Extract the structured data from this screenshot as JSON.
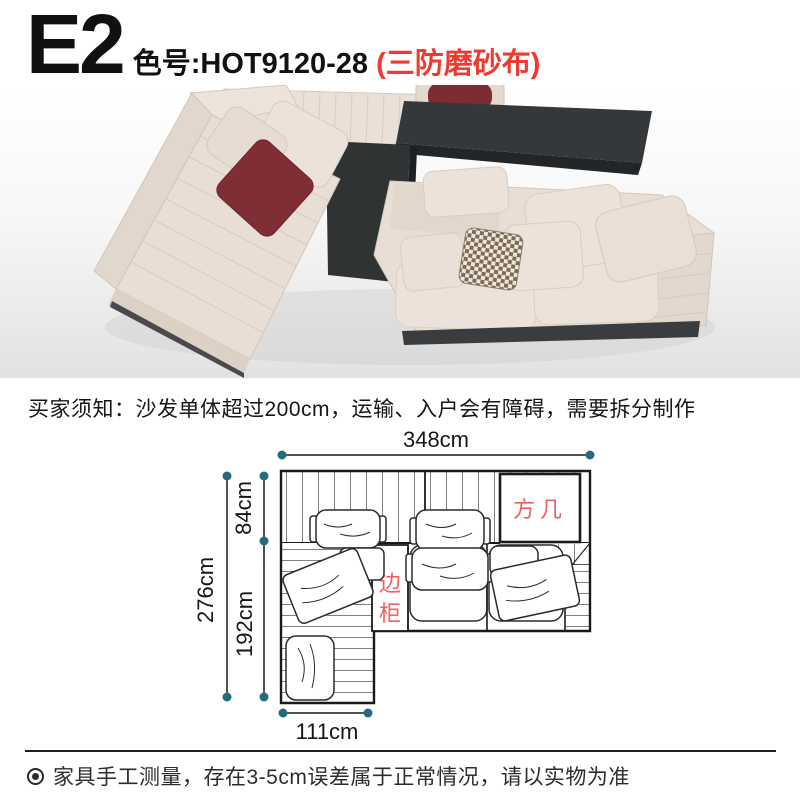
{
  "header": {
    "variant_code": "E2",
    "color_code_label": "色号:HOT9120-28",
    "fabric_badge": "(三防磨砂布)",
    "badge_color": "#ee3a2f"
  },
  "notice": {
    "buyer_note": "买家须知：沙发单体超过200cm，运输、入户会有障碍，需要拆分制作"
  },
  "diagram": {
    "total_width": "348cm",
    "total_depth": "276cm",
    "back_section_depth": "84cm",
    "front_section_depth": "192cm",
    "chaise_width": "111cm",
    "square_table_label": "方几",
    "side_cabinet_label": "边柜",
    "dot_color": "#266b7d",
    "label_color": "#f26060",
    "line_color": "#1a1a1a"
  },
  "footer": {
    "disclaimer": "家具手工测量，存在3-5cm误差属于正常情况，请以实物为准"
  },
  "photo": {
    "fabric_color": "#e8ded5",
    "table_color": "#35383a",
    "accent_pillow_color": "#7f2e35"
  }
}
